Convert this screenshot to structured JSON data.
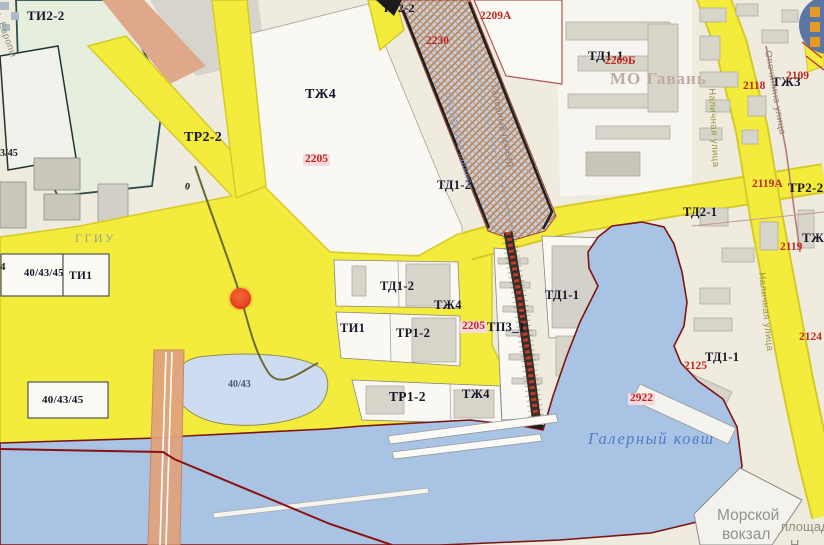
{
  "map": {
    "title": "Zoning map fragment (Gavan district, Vasilyevsky Island)",
    "colors": {
      "background": "#efecdf",
      "zone_yellow": "#f3ec3d",
      "zone_yellow_border": "#d6ca28",
      "water": "#a9c3e4",
      "pond": "#cddcf1",
      "water_outline": "#7d1412",
      "hatch_base": "#c6cdda",
      "hatch_stripe": "#b97f4e",
      "bridge_road": "#e2a27c",
      "red_boundary": "#8a1210",
      "building": "#d7d4ca",
      "marker_fill": "#ee4e28",
      "marker_ring": "#cf2c12",
      "legend_button_blue": "#5a76a3",
      "legend_button_orange": "#e59b25"
    },
    "marker": {
      "x": 230,
      "y": 288,
      "d": 21
    },
    "legend_button": {
      "rows": 3
    },
    "labels": {
      "zones": [
        {
          "id": "zone-ti2-2",
          "text": "ТИ2-2",
          "x": 27,
          "y": 9,
          "size": 13
        },
        {
          "id": "zone-tr2-2-w",
          "text": "ТР2-2",
          "x": 184,
          "y": 131,
          "size": 14
        },
        {
          "id": "zone-tzh4-n",
          "text": "ТЖ4",
          "x": 305,
          "y": 88,
          "size": 14
        },
        {
          "id": "zone-tr2-2-n",
          "text": "ТР2-2",
          "x": 382,
          "y": 2,
          "size": 12
        },
        {
          "id": "zone-td1-2-n",
          "text": "ТД1-2",
          "x": 437,
          "y": 179,
          "size": 12.5
        },
        {
          "id": "zone-td1-1-ne",
          "text": "ТД1-1",
          "x": 588,
          "y": 49,
          "size": 13
        },
        {
          "id": "zone-td2-1",
          "text": "ТД2-1",
          "x": 683,
          "y": 206,
          "size": 12.5
        },
        {
          "id": "zone-td1-2-c",
          "text": "ТД1-2",
          "x": 380,
          "y": 280,
          "size": 12.5
        },
        {
          "id": "zone-tzh4-c",
          "text": "ТЖ4",
          "x": 434,
          "y": 299,
          "size": 12.5
        },
        {
          "id": "zone-ti1-c",
          "text": "ТИ1",
          "x": 340,
          "y": 322,
          "size": 12.5
        },
        {
          "id": "zone-tr1-2-c",
          "text": "ТР1-2",
          "x": 396,
          "y": 327,
          "size": 12.5
        },
        {
          "id": "zone-tp3-1",
          "text": "ТП3_1",
          "x": 487,
          "y": 321,
          "size": 12.5
        },
        {
          "id": "zone-td1-1-c",
          "text": "ТД1-1",
          "x": 545,
          "y": 289,
          "size": 12.5
        },
        {
          "id": "zone-tr1-2-s",
          "text": "ТР1-2",
          "x": 389,
          "y": 390,
          "size": 13.5
        },
        {
          "id": "zone-tzh4-s",
          "text": "ТЖ4",
          "x": 462,
          "y": 388,
          "size": 12.5
        },
        {
          "id": "zone-td1-1-se",
          "text": "ТД1-1",
          "x": 705,
          "y": 351,
          "size": 12.5
        },
        {
          "id": "zone-tzh3-ne",
          "text": "ТЖ3",
          "x": 772,
          "y": 75,
          "size": 13
        },
        {
          "id": "zone-tzh3-e",
          "text": "ТЖ3",
          "x": 802,
          "y": 231,
          "size": 13
        },
        {
          "id": "zone-tr2-2-e",
          "text": "ТР2-2",
          "x": 788,
          "y": 181,
          "size": 13
        },
        {
          "id": "zone-ti1-w",
          "text": "ТИ1",
          "x": 69,
          "y": 271,
          "size": 11.5
        },
        {
          "id": "parcel-40-43-45-w",
          "text": "40/43/45",
          "x": 24,
          "y": 269,
          "size": 10.5
        },
        {
          "id": "parcel-40-43-45-s",
          "text": "40/43/45",
          "x": 42,
          "y": 395,
          "size": 11
        }
      ],
      "parcels": [
        {
          "id": "parcel-2205-n",
          "text": "2205",
          "x": 303,
          "y": 154,
          "bg": true
        },
        {
          "id": "parcel-2209a",
          "text": "2209А",
          "x": 480,
          "y": 11
        },
        {
          "id": "parcel-2230",
          "text": "2230",
          "x": 426,
          "y": 36
        },
        {
          "id": "parcel-2209b",
          "text": "2209Б",
          "x": 605,
          "y": 56
        },
        {
          "id": "parcel-2118",
          "text": "2118",
          "x": 743,
          "y": 81
        },
        {
          "id": "parcel-2109",
          "text": "2109",
          "x": 786,
          "y": 71
        },
        {
          "id": "parcel-2119",
          "text": "2119",
          "x": 780,
          "y": 242
        },
        {
          "id": "parcel-2119a",
          "text": "2119А",
          "x": 752,
          "y": 179
        },
        {
          "id": "parcel-2124",
          "text": "2124",
          "x": 799,
          "y": 332
        },
        {
          "id": "parcel-2125",
          "text": "2125",
          "x": 684,
          "y": 361
        },
        {
          "id": "parcel-2922",
          "text": "2922",
          "x": 628,
          "y": 393,
          "bg": true
        },
        {
          "id": "parcel-2205-c",
          "text": "2205",
          "x": 460,
          "y": 321,
          "bg": true
        }
      ],
      "areas": [
        {
          "id": "district-mo-gavan",
          "text": "МО Гавань",
          "x": 610,
          "y": 70,
          "size": 17,
          "color": "#c0aba3",
          "ls": 1
        },
        {
          "id": "label-ggiu",
          "text": "ГГИУ",
          "x": 75,
          "y": 232,
          "size": 12,
          "color": "#97a18b",
          "weight": "400",
          "ls": 2.5
        },
        {
          "id": "pond-parcel-40-43",
          "text": "40/43",
          "x": 228,
          "y": 380,
          "size": 10,
          "color": "#4e5a6e"
        },
        {
          "id": "marine-terminal-line1",
          "text": "Морской",
          "x": 717,
          "y": 508,
          "size": 15.5,
          "color": "#93928b",
          "weight": "400",
          "font": "sans"
        },
        {
          "id": "marine-terminal-line2",
          "text": "вокзал",
          "x": 722,
          "y": 527,
          "size": 15.5,
          "color": "#93928b",
          "weight": "400",
          "font": "sans"
        },
        {
          "id": "square-label-line1",
          "text": "площадь",
          "x": 781,
          "y": 520,
          "size": 13,
          "color": "#8d8c85",
          "weight": "400",
          "font": "sans"
        },
        {
          "id": "square-label-line2",
          "text": "Н",
          "x": 790,
          "y": 538,
          "size": 13,
          "color": "#8d8c85",
          "weight": "400",
          "font": "sans"
        }
      ],
      "water": [
        {
          "id": "water-galerny-kovsh",
          "text": "Галерный ковш",
          "x": 588,
          "y": 431
        }
      ],
      "streets": [
        {
          "id": "street-pl-evropy",
          "text": "пл. Европы",
          "x": -1,
          "y": 4,
          "rot": 70,
          "color": "#7e8e7e"
        },
        {
          "id": "street-nalichnaya-1",
          "text": "Наличная улица",
          "x": 716,
          "y": 88,
          "rot": 87,
          "color": "#9a9440"
        },
        {
          "id": "street-nalichnaya-2",
          "text": "Наличная улица",
          "x": 766,
          "y": 272,
          "rot": 84,
          "color": "#9a9440"
        },
        {
          "id": "street-opochinina",
          "text": "Опочинина улица",
          "x": 772,
          "y": 50,
          "rot": 80,
          "color": "#8f8274"
        },
        {
          "id": "street-galerny-proezd",
          "text": "Галерный проезд",
          "x": 498,
          "y": 84,
          "rot": 78,
          "color": "#8f8274"
        },
        {
          "id": "channel-shkiperskiy-protok",
          "text": "Шкиперский проток",
          "x": 452,
          "y": 92,
          "rot": 77,
          "color": "#86a2cf",
          "italic": true,
          "op": 0.75
        }
      ],
      "fragments": [
        {
          "id": "fragment-3-45",
          "text": "3/45",
          "x": 0,
          "y": 149
        },
        {
          "id": "fragment-4",
          "text": "4",
          "x": 0,
          "y": 262,
          "size": 11
        },
        {
          "id": "fragment-0",
          "text": "0",
          "x": 186,
          "y": 182,
          "rot": 15
        }
      ]
    }
  }
}
